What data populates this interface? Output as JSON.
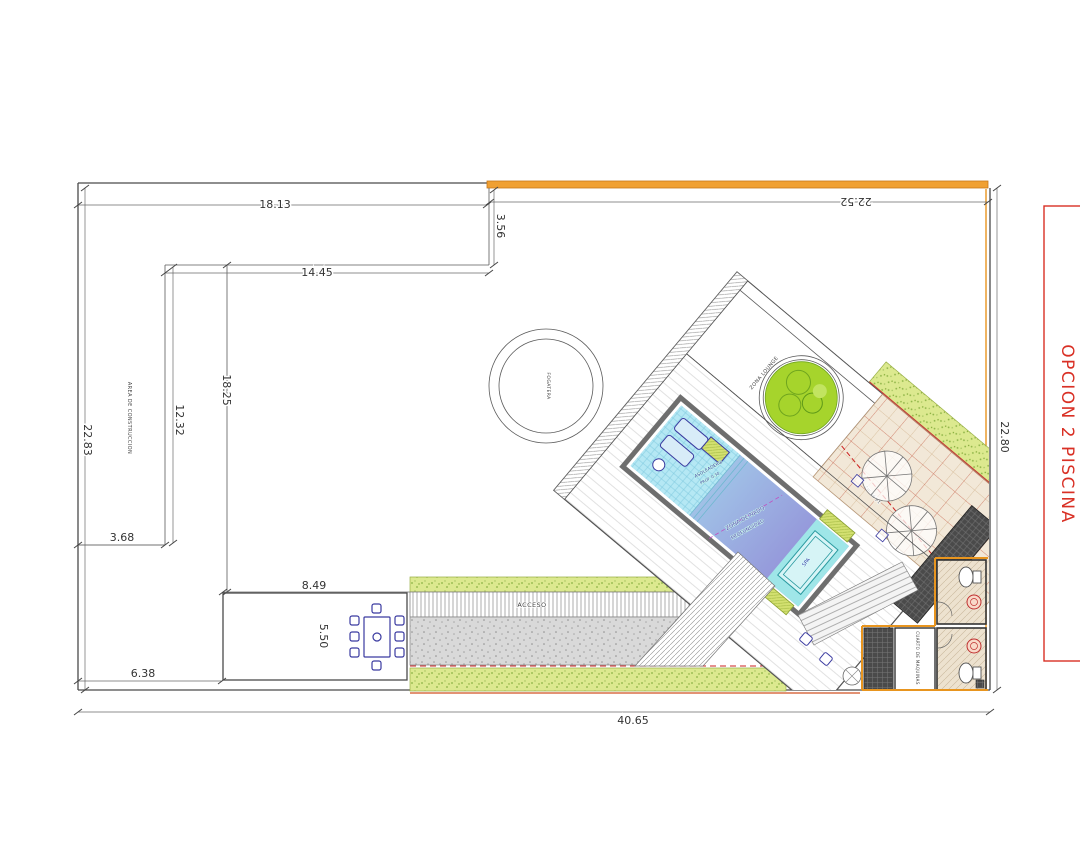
{
  "drawing": {
    "title": "OPCION 2 PISCINA",
    "dimensions": {
      "top_width": "18.13",
      "top_right_width": "22.52",
      "top_inset": "3.56",
      "inner_width": "14.45",
      "left_height": "22.83",
      "left_inner_height": "12.32",
      "construction_height": "18.25",
      "left_inset": "3.68",
      "dining_width": "8.49",
      "dining_depth": "5.50",
      "bottom_left_width": "6.38",
      "total_width": "40.65",
      "right_height": "22.80"
    },
    "labels": {
      "construction_area": "AREA DE CONSTRUCCION",
      "fire_pit": "FOGATERA",
      "lounge_zone": "ZONA LOUNGE",
      "access": "ACCESO",
      "boundary": "COLINDANCIA",
      "swim_zone": "ZONA DE NADO",
      "depth": "PROFUNDIDAD",
      "sun_shelf": "ASOLEADERO",
      "sun_shelf_depth": "PROF. 0.30",
      "spa": "SPA",
      "machine_room": "CUARTO DE MAQUINAS",
      "terrace_area": "14.90 m2"
    },
    "colors": {
      "accent_orange": "#E8951F",
      "boundary_red": "#CC2222",
      "title_red": "#D93025",
      "pool_shallow": "#AEE4F2",
      "pool_deep": "#9189D6",
      "grass_green": "#D9E88A",
      "tree_green": "#A6D42C",
      "terrace_tan": "#F2E8D8",
      "furniture_blue": "#3A3AA0",
      "line_dark": "#3C3C3C"
    }
  }
}
